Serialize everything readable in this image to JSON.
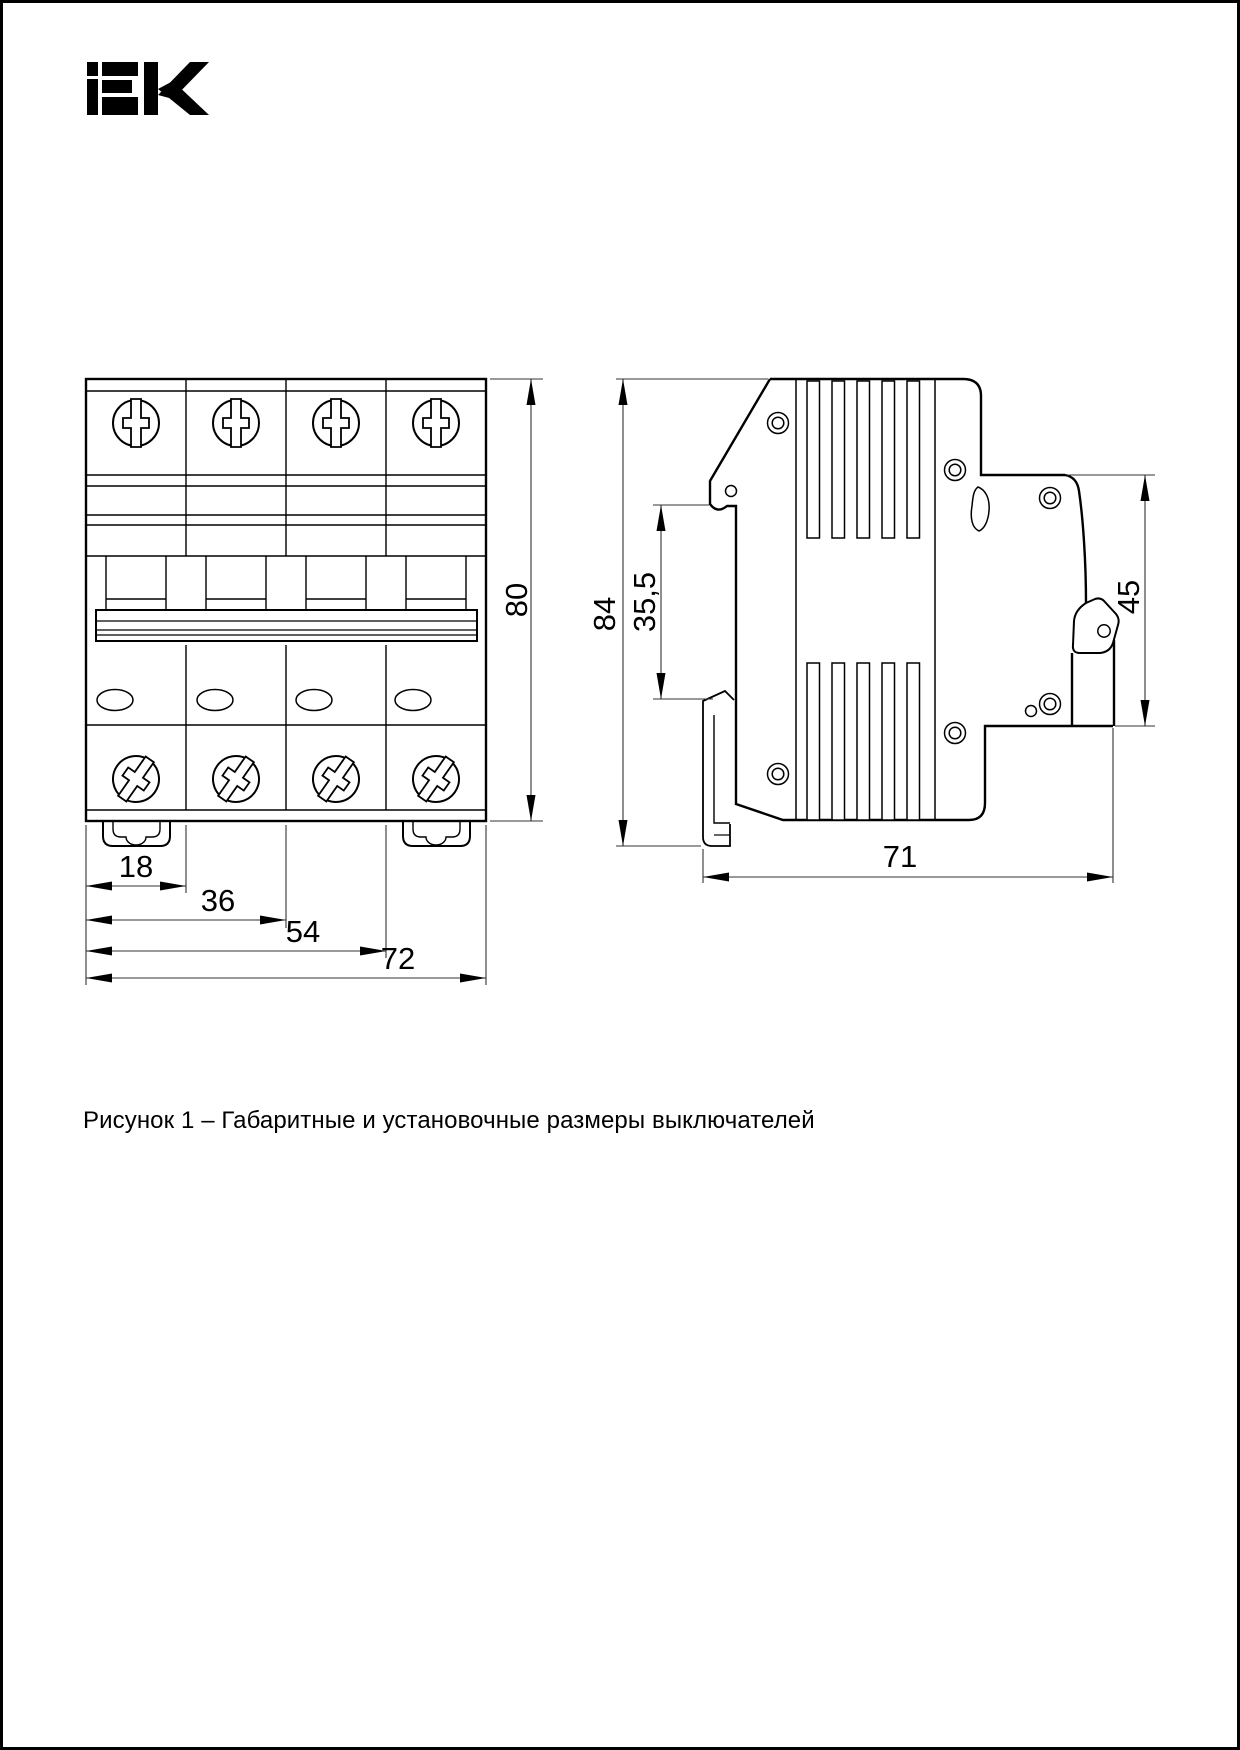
{
  "page": {
    "background": "#ffffff",
    "border_color": "#000000",
    "line_color": "#000000"
  },
  "logo": {
    "text": "IEK",
    "color": "#000000"
  },
  "figure": {
    "caption": "Рисунок 1 – Габаритные и установочные размеры выключателей",
    "front_view": {
      "description": "front view of 4-pole circuit breaker",
      "dim_height": "80",
      "dim_width_1": "18",
      "dim_width_2": "36",
      "dim_width_3": "54",
      "dim_width_4": "72"
    },
    "side_view": {
      "description": "side profile of circuit breaker",
      "dim_height": "84",
      "dim_din_offset": "35,5",
      "dim_face_height": "45",
      "dim_depth": "71"
    }
  }
}
